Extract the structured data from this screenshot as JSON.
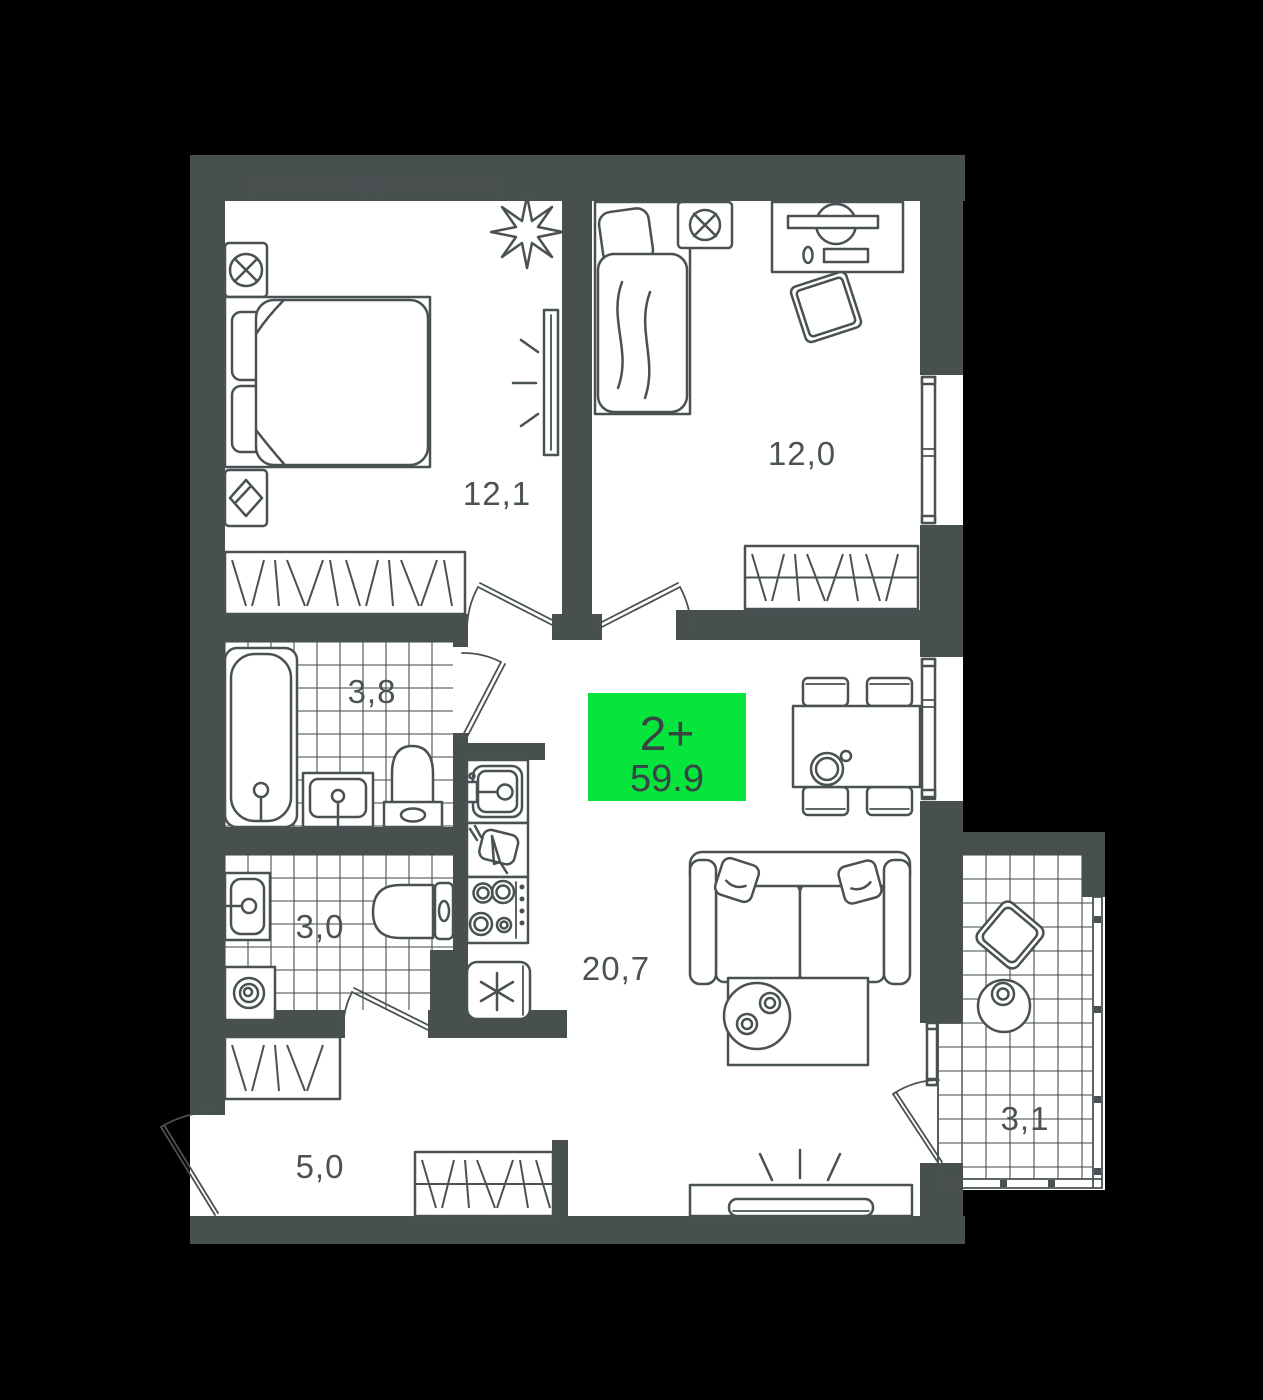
{
  "badge": {
    "type": "2+",
    "area": "59.9"
  },
  "rooms": [
    {
      "name": "bedroom-1",
      "area": "12,1"
    },
    {
      "name": "bedroom-2",
      "area": "12,0"
    },
    {
      "name": "bathroom",
      "area": "3,8"
    },
    {
      "name": "toilet",
      "area": "3,0"
    },
    {
      "name": "living-kitchen",
      "area": "20,7"
    },
    {
      "name": "hallway",
      "area": "5,0"
    },
    {
      "name": "balcony",
      "area": "3,1"
    }
  ],
  "colors": {
    "background": "#000000",
    "wall": "#484F4F",
    "line": "#4A5152",
    "floor": "#FFFFFF",
    "badge_bg": "#05E53C",
    "badge_text": "#3A4344",
    "label_text": "#4A5253"
  },
  "icons": [
    "double-bed-icon",
    "single-bed-icon",
    "pillow-icon",
    "wardrobe-icon",
    "plant-icon",
    "tv-icon",
    "bathtub-icon",
    "sink-icon",
    "toilet-icon",
    "washing-machine-icon",
    "kitchen-sink-icon",
    "cutting-board-icon",
    "stove-icon",
    "fridge-icon",
    "sofa-icon",
    "coffee-table-icon",
    "dining-table-icon",
    "chair-icon",
    "teapot-icon",
    "door-arc-icon",
    "window-icon",
    "desk-icon",
    "fan-icon",
    "book-icon"
  ]
}
